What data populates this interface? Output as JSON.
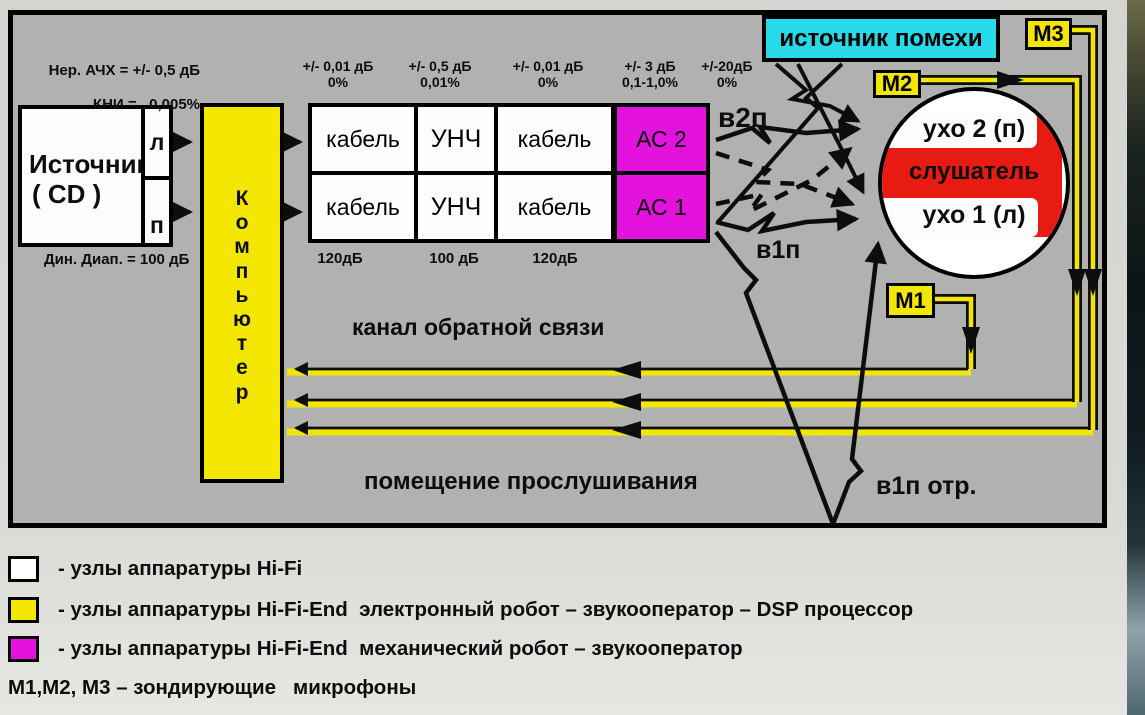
{
  "colors": {
    "board_gray": "#b1b1af",
    "accent_yellow": "#f3e600",
    "accent_magenta": "#e312dd",
    "accent_cyan": "#27d9e9",
    "accent_red": "#e71b12",
    "line_black": "#0d0d0d"
  },
  "source": {
    "title": "Источник",
    "subtitle": "( CD )",
    "spec_top": "Нер. АЧХ = +/- 0,5 дБ",
    "spec_bottom": "КНИ =   0,005%",
    "spec_under": "Дин. Диап. = 100 дБ",
    "channel_top": "л",
    "channel_bottom": "п"
  },
  "computer": {
    "letters": [
      "К",
      "о",
      "м",
      "п",
      "ь",
      "ю",
      "т",
      "е",
      "р"
    ]
  },
  "chain": {
    "specs": [
      {
        "top": "+/- 0,01 дБ",
        "bottom": "0%"
      },
      {
        "top": "+/- 0,5 дБ",
        "bottom": "0,01%"
      },
      {
        "top": "+/- 0,01 дБ",
        "bottom": "0%"
      },
      {
        "top": "+/- 3 дБ",
        "bottom": "0,1-1,0%"
      },
      {
        "top": "+/-20дБ",
        "bottom": "0%"
      }
    ],
    "row1": [
      "кабель",
      "УНЧ",
      "кабель"
    ],
    "row2": [
      "кабель",
      "УНЧ",
      "кабель"
    ],
    "speaker_top": "АС 2",
    "speaker_bottom": "АС 1",
    "under": [
      "120дБ",
      "100 дБ",
      "120дБ"
    ]
  },
  "noise": {
    "label": "источник помехи"
  },
  "mics": {
    "m1": "М1",
    "m2": "М2",
    "m3": "М3"
  },
  "listener": {
    "ear_top": "ухо 2 (п)",
    "center": "слушатель",
    "ear_bottom": "ухо 1 (л)"
  },
  "paths": {
    "v2p": "в2п",
    "v1p": "в1п",
    "v1p_refl": "в1п отр.",
    "feedback": "канал обратной связи",
    "room": "помещение прослушивания"
  },
  "legend": {
    "items": [
      {
        "color": "#ffffff",
        "text": "- узлы аппаратуры Hi-Fi"
      },
      {
        "color": "#f3e600",
        "text": "- узлы аппаратуры Hi-Fi-End  электронный робот – звукооператор – DSP процессор"
      },
      {
        "color": "#e312dd",
        "text": "- узлы аппаратуры Hi-Fi-End  механический робот – звукооператор"
      }
    ],
    "note": "М1,М2, М3 – зондирующие   микрофоны"
  }
}
